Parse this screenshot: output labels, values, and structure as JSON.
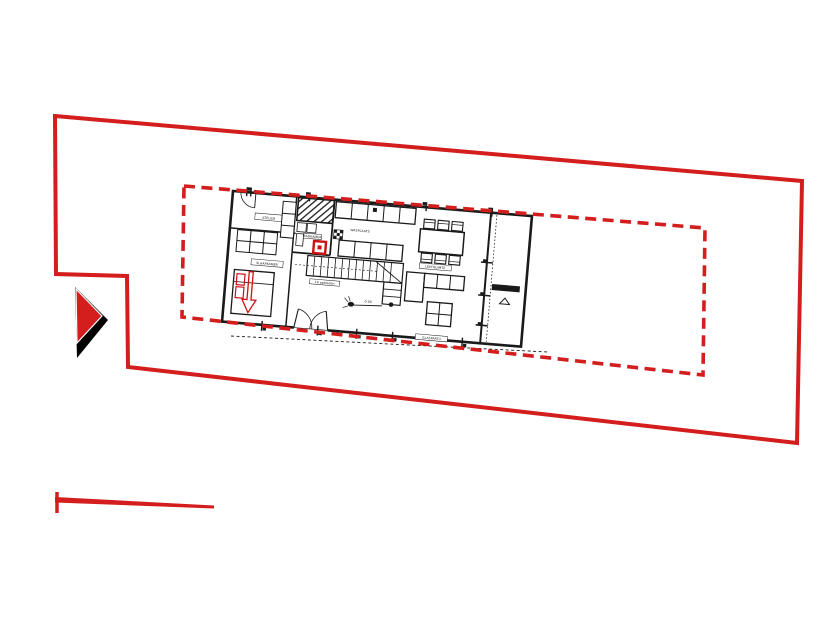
{
  "drawing": {
    "kind": "site plan with ground floor plan",
    "colors": {
      "boundary_red": "#d41d1d",
      "plan_black": "#1a1a1a",
      "accent_red": "#cc1111",
      "background": "#ffffff"
    }
  },
  "floor_plan": {
    "labels": {
      "atelier": "ATELIER",
      "bedroom": "SLAAPKAMER",
      "bathroom": "BADKAMER",
      "kitchen": "WASPLAATS",
      "living": "LEEFRUIMTE",
      "terrace": "TERRAS",
      "stair": "16 optreden",
      "bottom_wall": "GLASPARTIJ",
      "level_marker": "0.00"
    }
  }
}
